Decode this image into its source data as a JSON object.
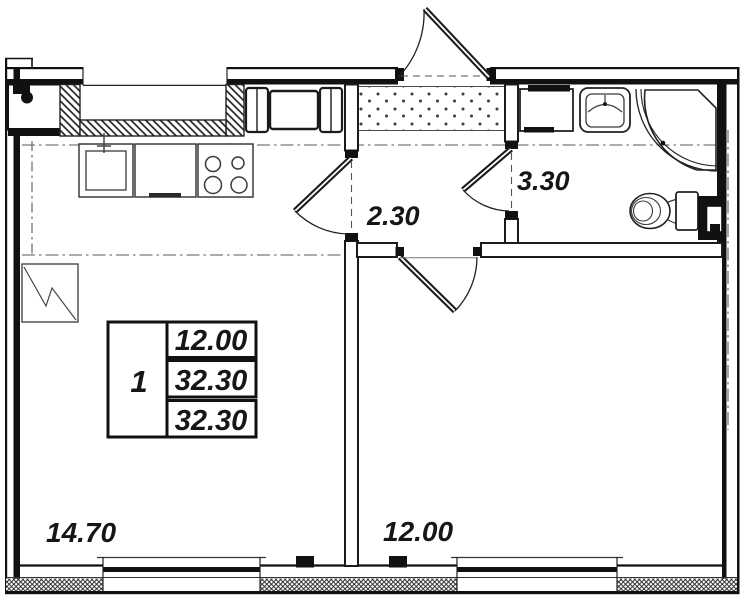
{
  "plan_labels": {
    "kitchen_living_area": "14.70",
    "bedroom_area": "12.00",
    "hallway_area": "2.30",
    "bathroom_area": "3.30"
  },
  "area_table": {
    "room_count": "1",
    "living_area": "12.00",
    "total_area": "32.30",
    "total_area_with_summer": "32.30"
  },
  "colors": {
    "line": "#1b1b1b",
    "light_line": "#555555",
    "background": "#ffffff"
  }
}
